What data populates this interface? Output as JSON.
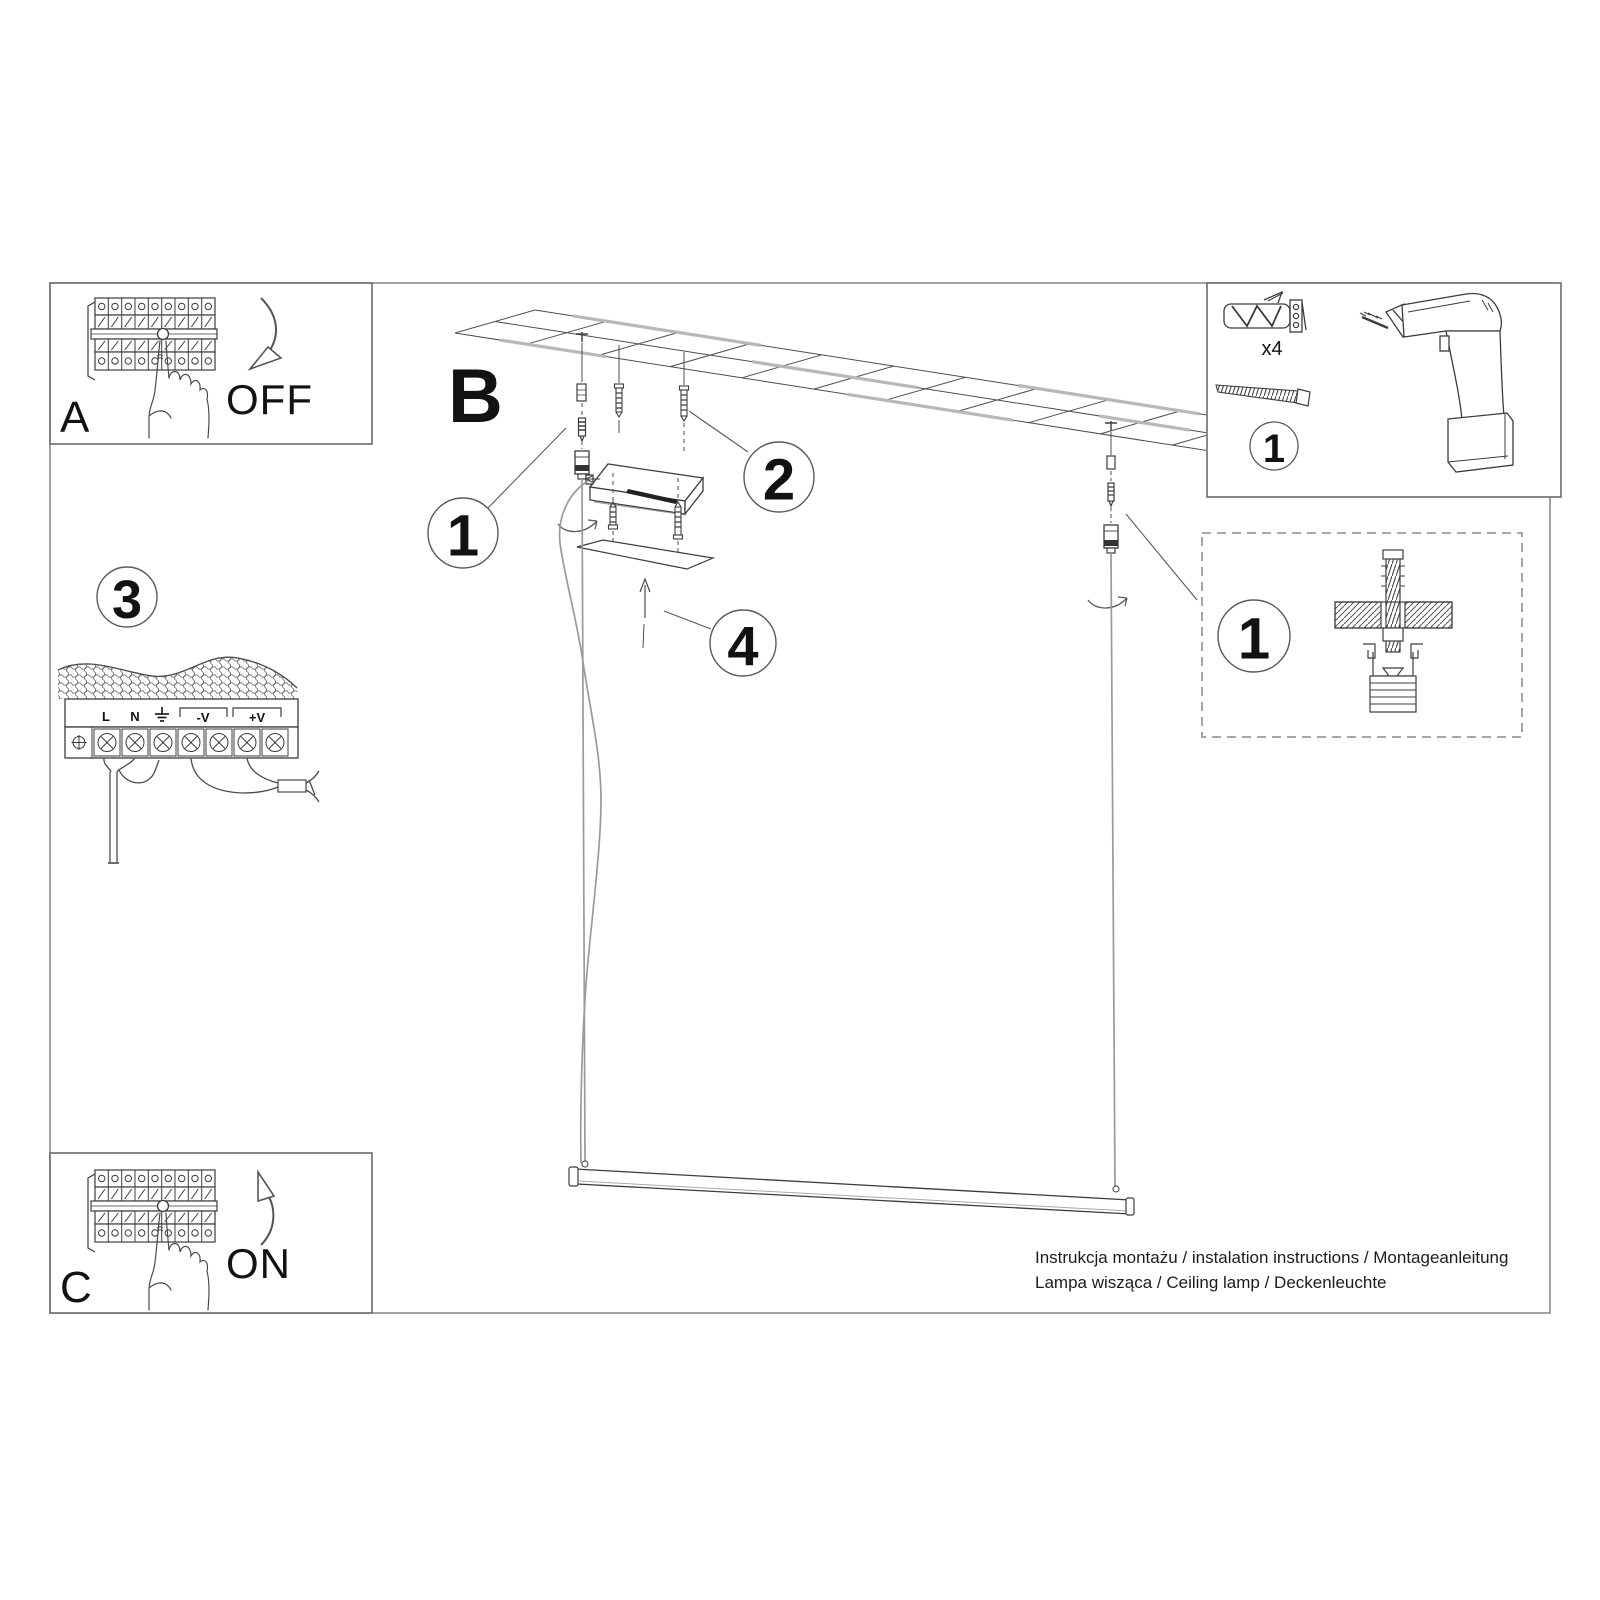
{
  "sheet": {
    "footer": {
      "line1": "Instrukcja montażu / instalation instructions / Montageanleitung",
      "line2": "Lampa wisząca / Ceiling lamp / Deckenleuchte"
    },
    "colors": {
      "line": "#3c3c3c",
      "frame": "#8a8a8a",
      "runner_gray": "#b8b8b8"
    }
  },
  "panels": {
    "breaker_off": {
      "label": "A",
      "state": "OFF",
      "icon": "circuit-breaker-icon"
    },
    "breaker_on": {
      "label": "C",
      "state": "ON",
      "icon": "circuit-breaker-icon"
    },
    "main_step": {
      "label": "B"
    },
    "wiring": {
      "step_number": "3",
      "terminal_labels": {
        "live": "L",
        "neutral": "N",
        "negative": "-V",
        "positive": "+V"
      },
      "earth_icon": "earth-ground-icon"
    },
    "hardware": {
      "step_number": "1",
      "quantity": "x4",
      "icons": [
        "wall-plug-icon",
        "screw-icon",
        "drill-icon"
      ]
    },
    "anchor_detail": {
      "step_number": "1",
      "icon": "anchor-cross-section-icon"
    }
  },
  "callouts": {
    "c1": "1",
    "c2": "2",
    "c4": "4"
  }
}
